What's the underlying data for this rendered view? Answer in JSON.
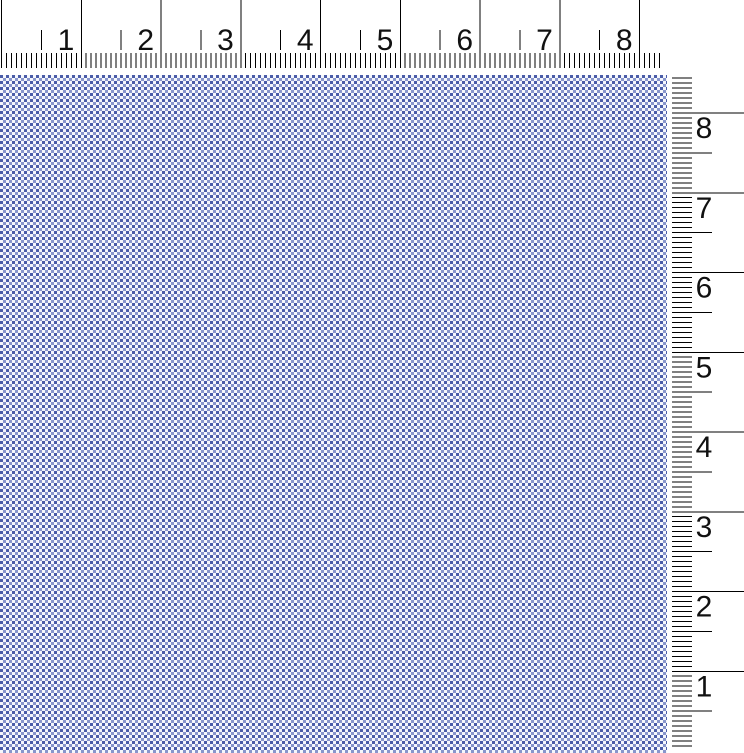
{
  "view": {
    "title": "Fabric swatch with inch rulers"
  },
  "top_ruler": {
    "orientation": "horizontal",
    "unit_labels": [
      "1",
      "2",
      "3",
      "4",
      "5",
      "6",
      "7",
      "8"
    ],
    "line_color": "#000000",
    "text_color": "#111111"
  },
  "right_ruler": {
    "orientation": "vertical",
    "unit_labels_top_to_bottom": [
      "8",
      "7",
      "6",
      "5",
      "4",
      "3",
      "2",
      "1"
    ],
    "line_color": "#000000",
    "text_color": "#111111"
  },
  "fabric": {
    "pattern": "micro-check-gingham",
    "colors": {
      "dark": "#4a5ca8",
      "medium": "#8795cc",
      "light": "#f5f7fc"
    }
  }
}
